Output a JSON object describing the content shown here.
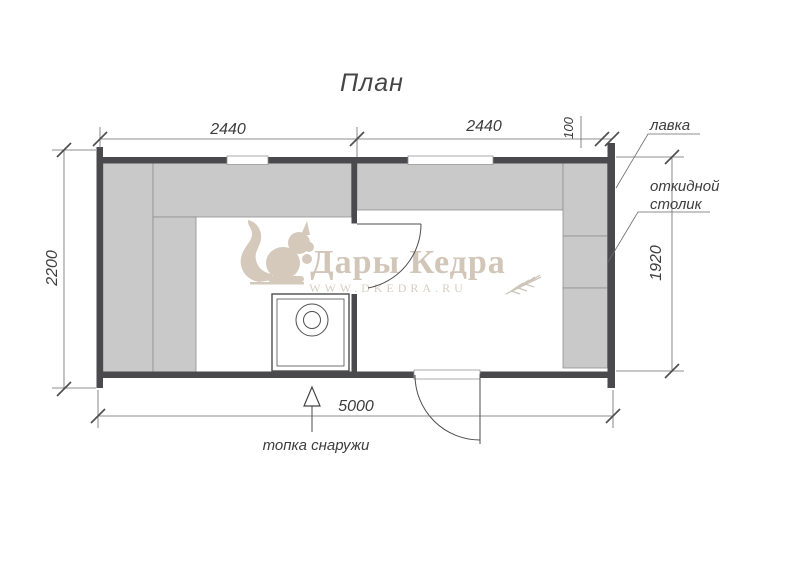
{
  "title": "План",
  "dimensions": {
    "room_left_width": "2440",
    "room_right_width": "2440",
    "wall_offset": "100",
    "total_height": "2200",
    "room_right_height": "1920",
    "total_width": "5000"
  },
  "labels": {
    "bench": "лавка",
    "folding_table_line1": "откидной",
    "folding_table_line2": "столик",
    "firebox_note": "топка снаружи"
  },
  "watermark": {
    "brand": "Дары Кедра",
    "website": "WWW.DKEDRA.RU"
  },
  "colors": {
    "wall": "#4a4a4c",
    "bench_fill": "#c9c9ca",
    "line": "#6a6a6a",
    "watermark": "#d5c9bc"
  }
}
